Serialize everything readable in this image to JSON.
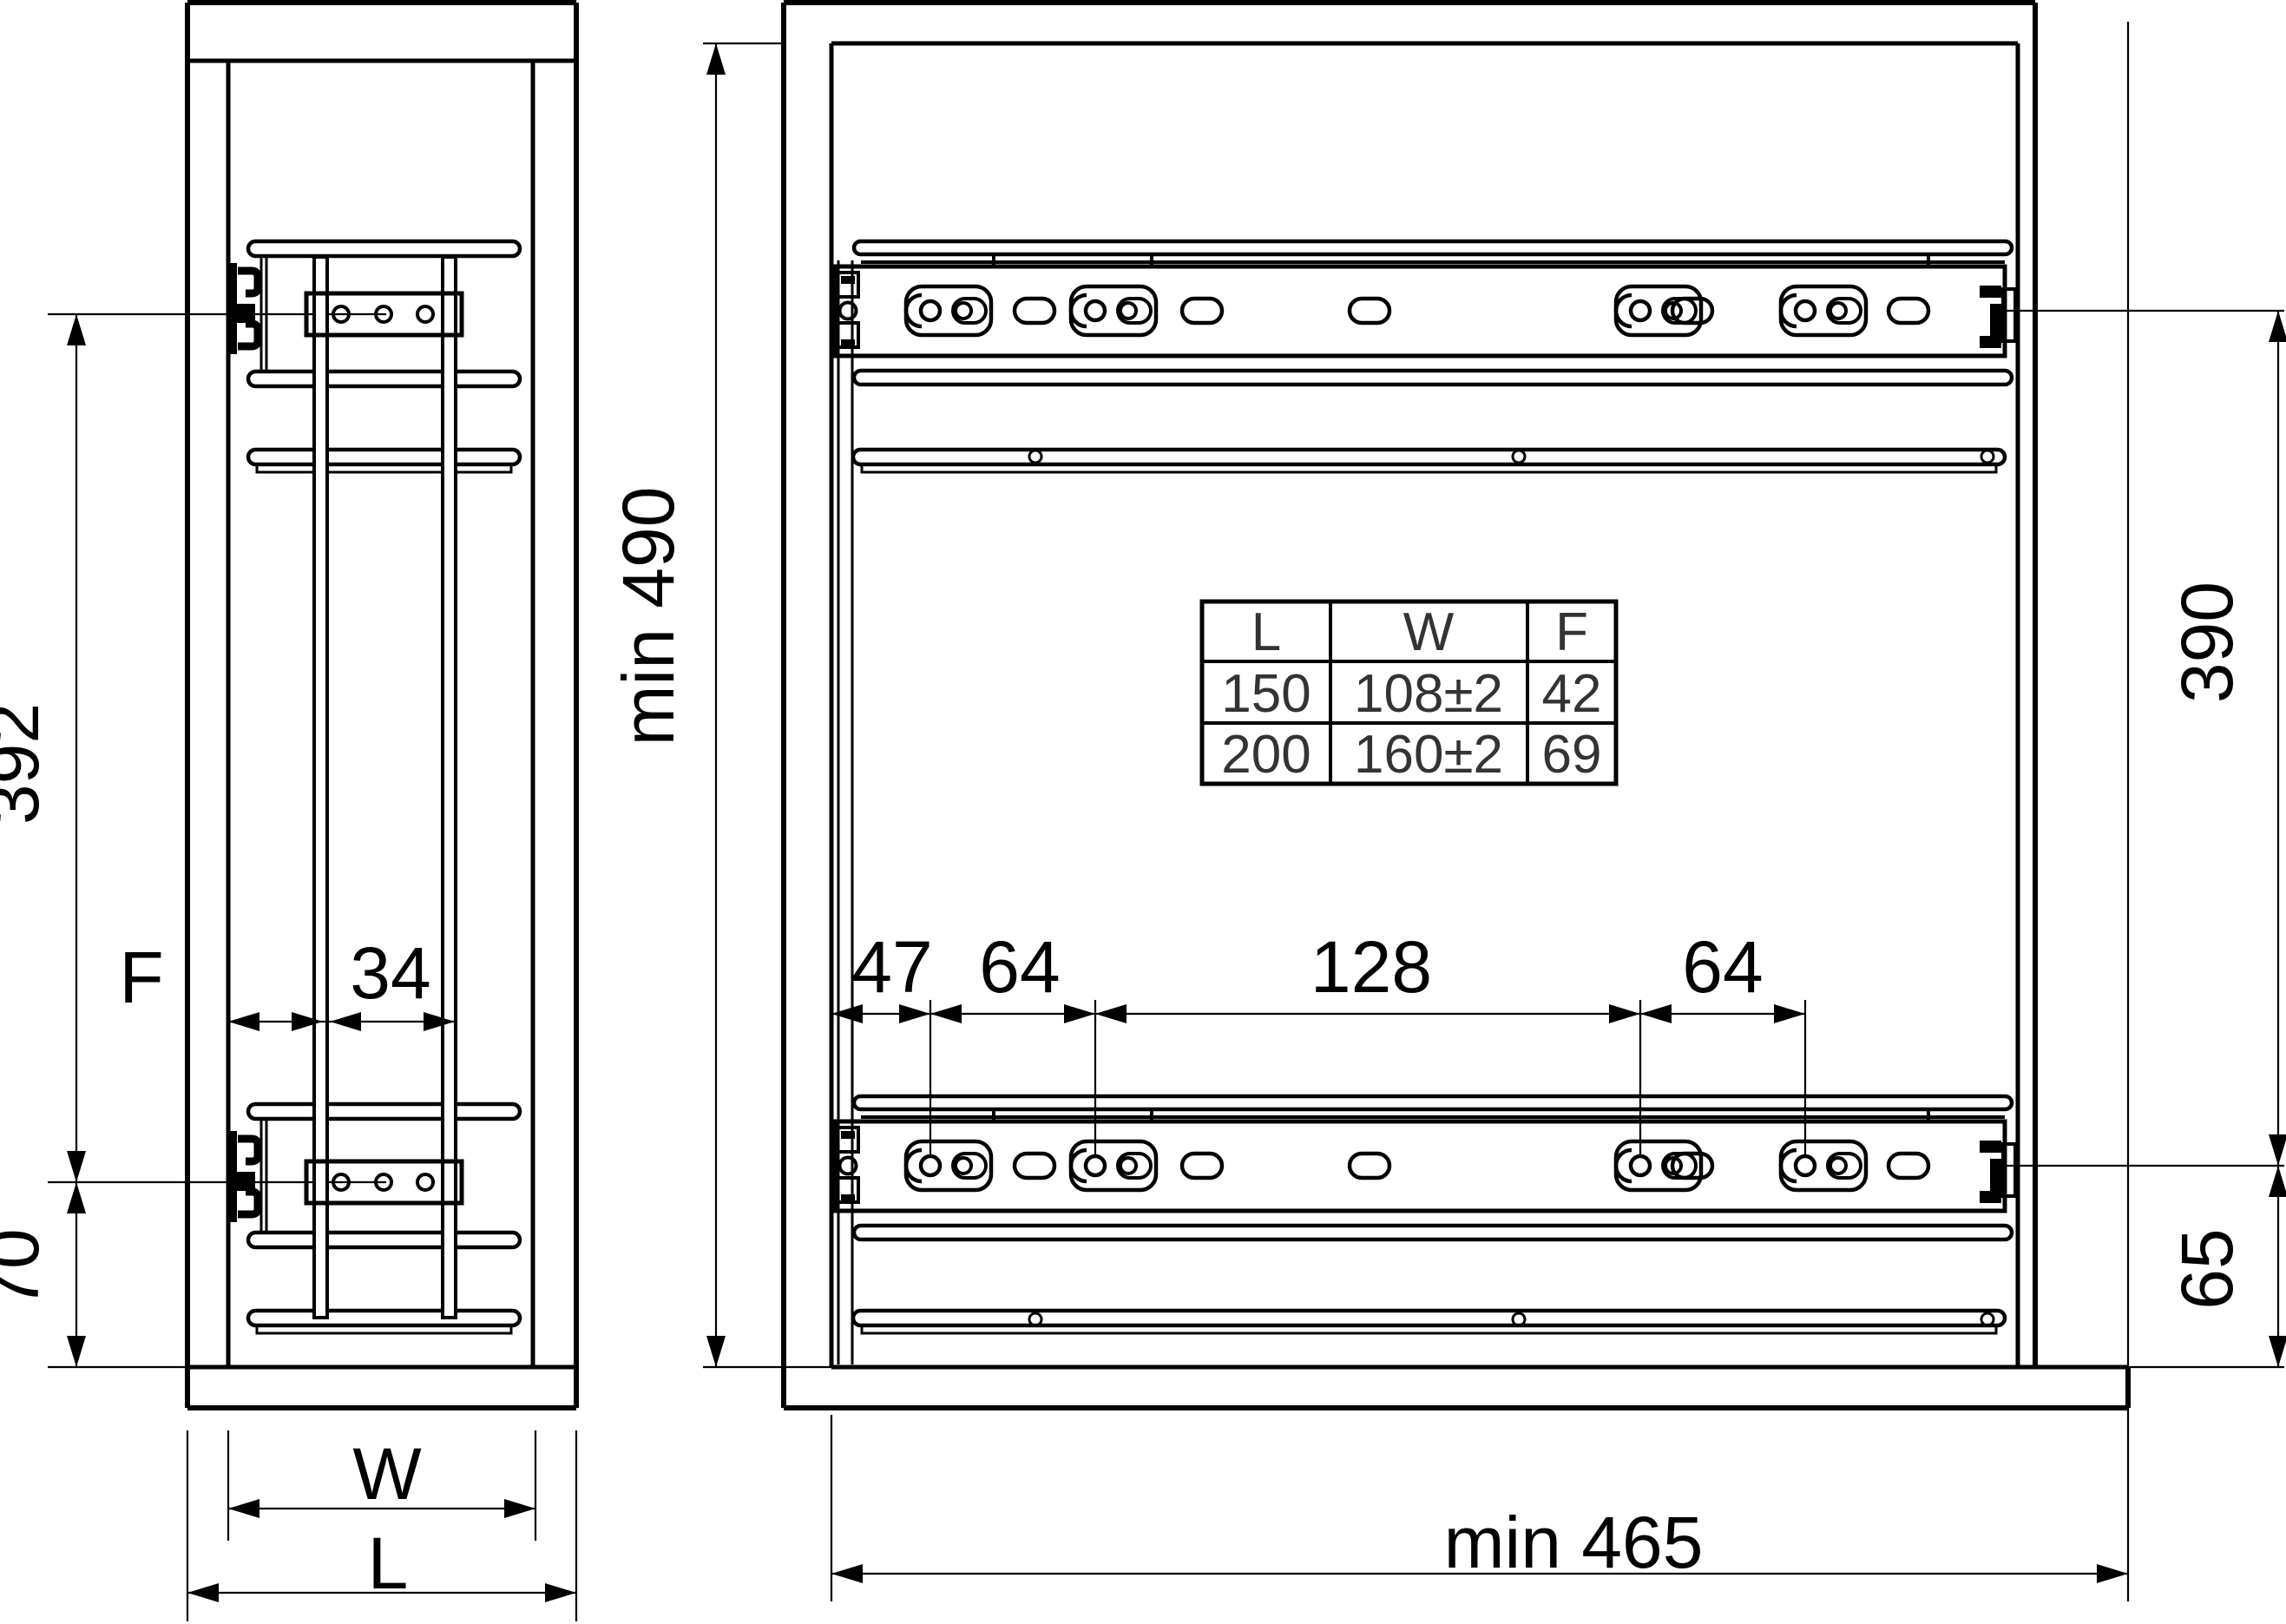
{
  "drawing": {
    "front_view": {
      "dim_392": "392",
      "dim_70": "70",
      "dim_f": "F",
      "dim_34": "34",
      "dim_w": "W",
      "dim_l": "L"
    },
    "side_view": {
      "dim_min_height": "min 490",
      "dim_47": "47",
      "dim_64_first": "64",
      "dim_128": "128",
      "dim_64_second": "64",
      "dim_390": "390",
      "dim_65": "65",
      "dim_min_depth": "min 465"
    },
    "table": {
      "headers": [
        "L",
        "W",
        "F"
      ],
      "rows": [
        [
          "150",
          "108±2",
          "42"
        ],
        [
          "200",
          "160±2",
          "69"
        ]
      ]
    },
    "colors": {
      "line": "#000000",
      "background": "#ffffff",
      "text": "#111111",
      "table_text": "#333333"
    }
  }
}
